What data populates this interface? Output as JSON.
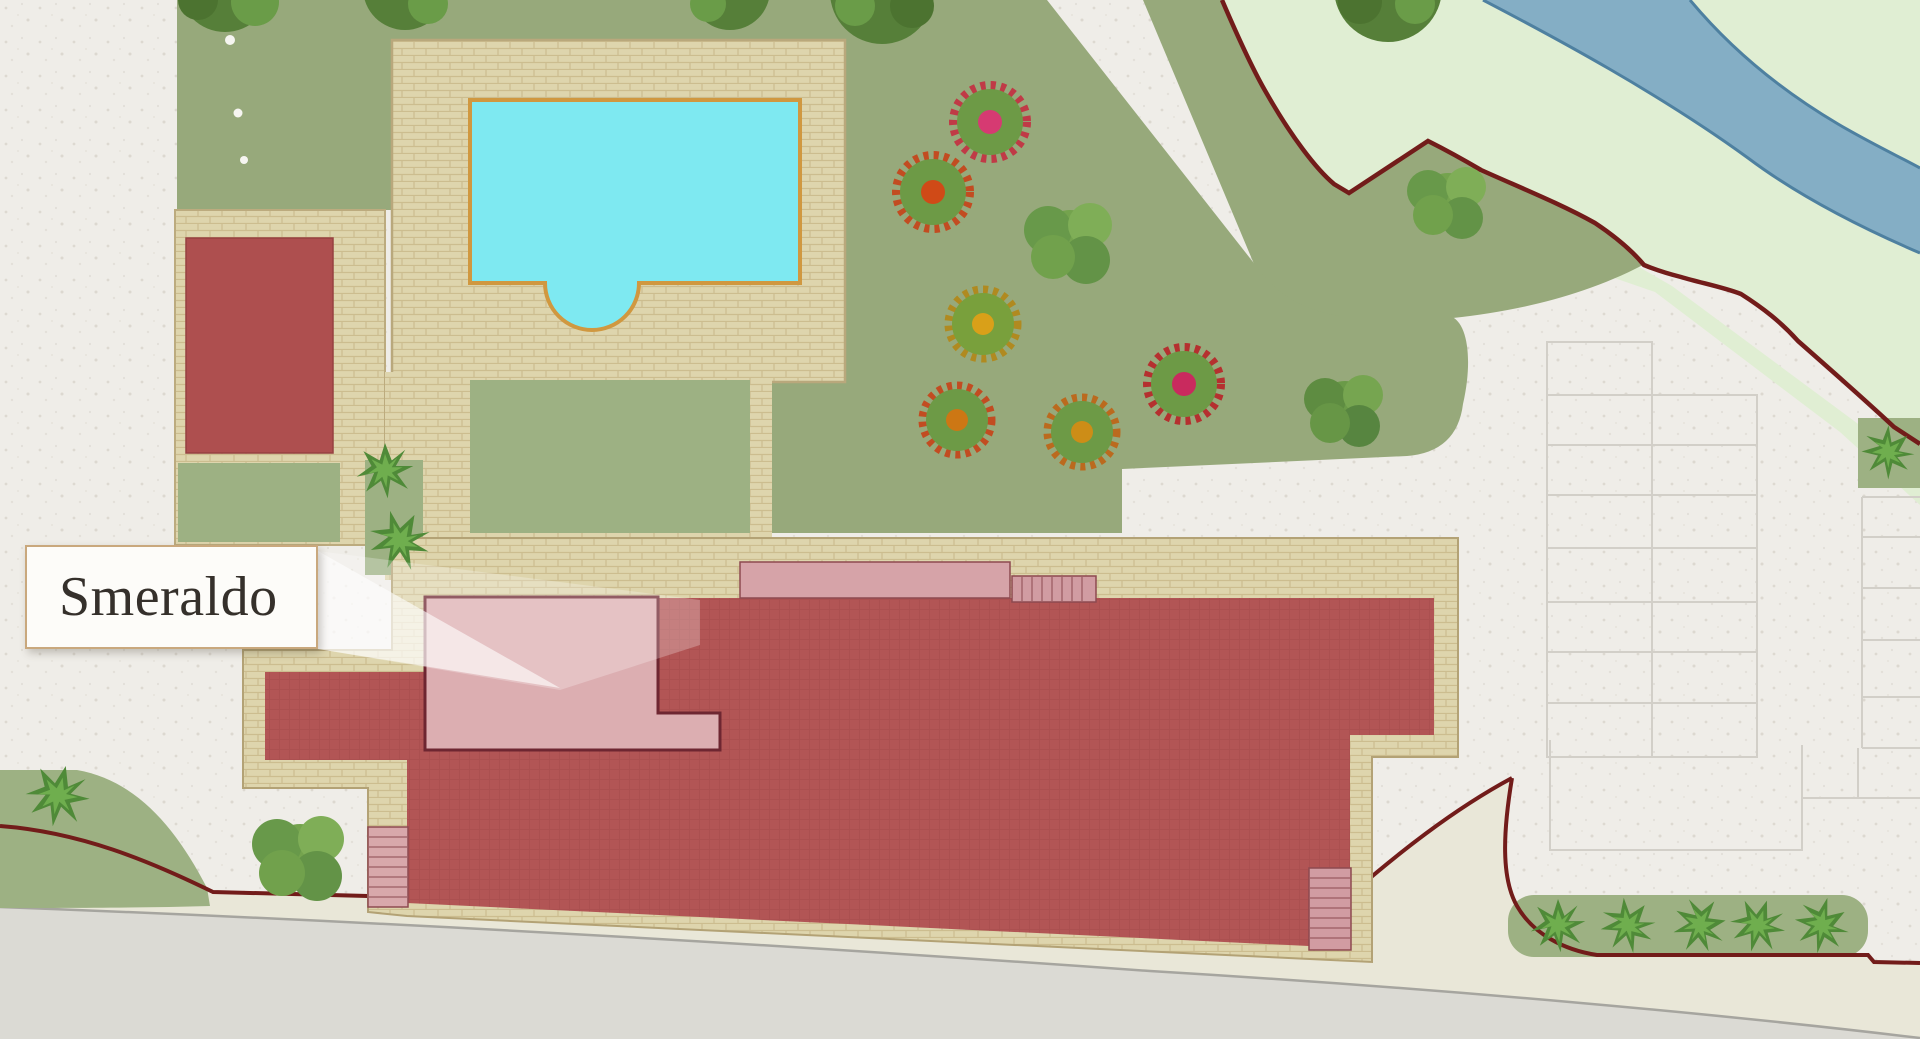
{
  "map": {
    "label": {
      "text": "Smeraldo"
    },
    "colors": {
      "paper": "#efede8",
      "lawn": "#97a97b",
      "lawn_panel": "#9db183",
      "pale_green": "#e0eed3",
      "river_water": "#84aec5",
      "river_edge": "#4e80a0",
      "cream_verge": "#e9e7d8",
      "road": "#dbdad4",
      "deck": "#ded5ad",
      "pool_water": "#7ee9f1",
      "pool_border": "#d09840",
      "building_red": "#b25555",
      "outbuilding_red": "#ae4f4f",
      "highlight_pink": "#dcaeb1",
      "roof_pink": "#d6a3a8",
      "boundary_maroon": "#721c1a",
      "label_border": "#c9a87d",
      "label_text": "#35302b"
    }
  }
}
